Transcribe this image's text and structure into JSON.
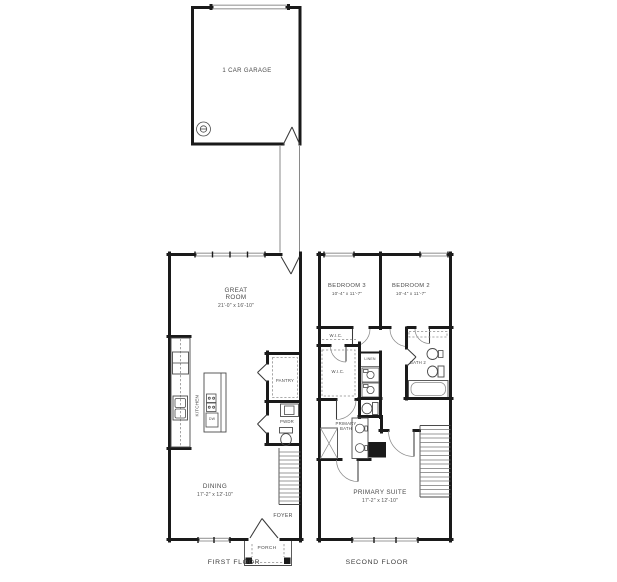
{
  "colors": {
    "wall": "#1a1a1a",
    "text": "#4a4a4a",
    "caption": "#3c3c3c",
    "window": "#9a9a9a"
  },
  "garage": {
    "label": "1 CAR GARAGE"
  },
  "first_floor": {
    "caption": "FIRST FLOOR",
    "great_room": {
      "name": "GREAT ROOM",
      "dims": "21'-0\" x 16'-10\""
    },
    "kitchen": {
      "name": "KITCHEN"
    },
    "dishwasher": {
      "name": "DW"
    },
    "pantry": {
      "name": "PANTRY"
    },
    "powder": {
      "name": "PWDR"
    },
    "dining": {
      "name": "DINING",
      "dims": "17'-2\" x 12'-10\""
    },
    "foyer": {
      "name": "FOYER"
    },
    "porch": {
      "name": "PORCH"
    }
  },
  "second_floor": {
    "caption": "SECOND FLOOR",
    "bedroom3": {
      "name": "BEDROOM 3",
      "dims": "10'-4\" x 11'-7\""
    },
    "bedroom2": {
      "name": "BEDROOM 2",
      "dims": "10'-4\" x 11'-7\""
    },
    "wic_small": {
      "name": "W.I.C."
    },
    "wic_large": {
      "name": "W.I.C."
    },
    "linen": {
      "name": "LINEN"
    },
    "bath2": {
      "name": "BATH 2"
    },
    "primary_bath": {
      "name": "PRIMARY BATH"
    },
    "primary_suite": {
      "name": "PRIMARY SUITE",
      "dims": "17'-2\" x 12'-10\""
    }
  }
}
